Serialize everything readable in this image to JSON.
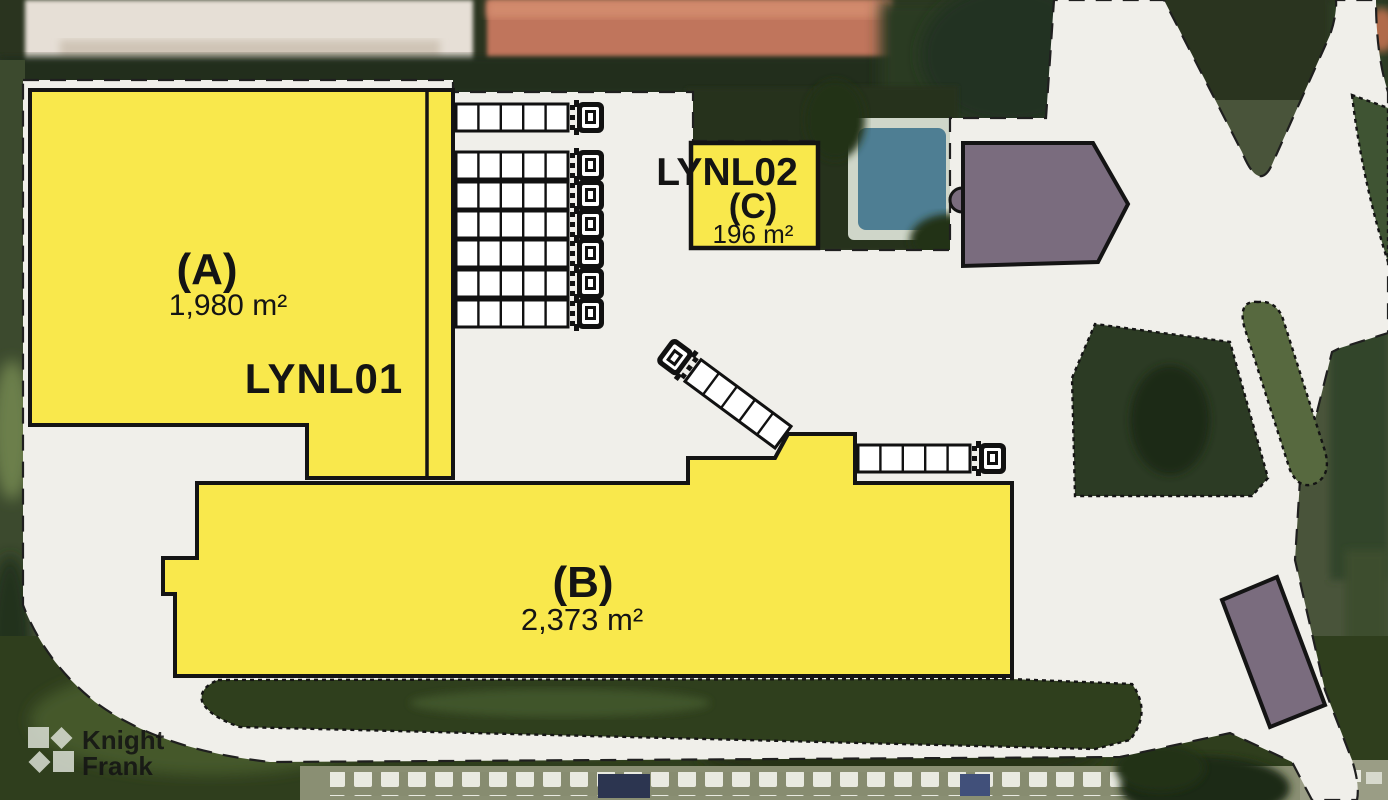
{
  "site_plan": {
    "units": [
      {
        "id": "A",
        "label": "(A)",
        "area": "1,980 m²",
        "scheme_code": "LYNL01",
        "status_color": "#F9E84C"
      },
      {
        "id": "B",
        "label": "(B)",
        "area": "2,373 m²",
        "status_color": "#F9E84C"
      },
      {
        "id": "C",
        "label": "(C)",
        "area": "196 m²",
        "scheme_code": "LYNL02",
        "status_color": "#F9E84C"
      }
    ],
    "other_buildings": [
      {
        "id": "pentagon-building",
        "color": "#7A6C7E"
      },
      {
        "id": "small-building",
        "color": "#7A6C7E"
      }
    ],
    "colors": {
      "available_yellow": "#F9E84C",
      "neighbour_purple": "#7A6C7E",
      "site_overlay_grey": "#F0EFEA",
      "outline_black": "#141414"
    },
    "branding": {
      "line1": "Knight",
      "line2": "Frank"
    }
  }
}
